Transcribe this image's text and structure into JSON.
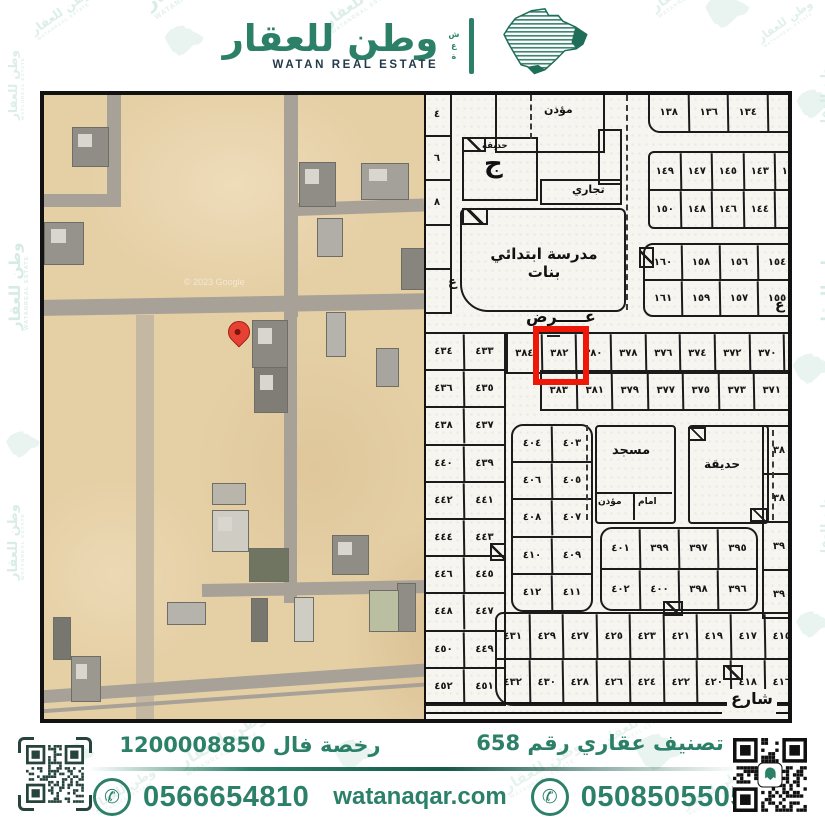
{
  "header": {
    "brand_ar": "وطن للعقار",
    "brand_en": "WATAN REAL ESTATE",
    "emblem_side_text": [
      "ش",
      "ع",
      "ة"
    ],
    "emblem_icon": "saudi-arabia-map",
    "brand_green": "#2c8068",
    "brand_navy": "#223a4b"
  },
  "watermark": {
    "text_ar": "وطن للعقار",
    "text_en": "WATANREAL ESTATE"
  },
  "satellite": {
    "credit": "© 2023 Google",
    "pin_color": "#e74133"
  },
  "map": {
    "street_label_top": "عـــــرض",
    "street_label_bottom": "شارع",
    "street_letter_right": "ع",
    "street_letter_left": "ع",
    "highlight_color": "#ee1708",
    "highlighted_plot": "٣٨٢",
    "labels": {
      "muezzin_top": "مؤذن",
      "park_top": "حديقة",
      "park_top_letter": "ج",
      "commercial": "تجاري",
      "school": "مدرسة ابتدائي بنات",
      "mosque": "مسجد",
      "imam": "امام",
      "muezzin": "مؤذن",
      "park": "حديقة"
    },
    "blocks": {
      "left_top_col": [
        [
          "٤"
        ],
        [
          "٦"
        ],
        [
          "٨"
        ],
        [
          ""
        ],
        [
          ""
        ]
      ],
      "top_right_1": [
        [
          "١٣٨",
          "١٣٦",
          "١٣٤",
          ""
        ]
      ],
      "top_right_2": [
        [
          "١٤٩",
          "١٤٧",
          "١٤٥",
          "١٤٣",
          "١٤١"
        ],
        [
          "١٥٠",
          "١٤٨",
          "١٤٦",
          "١٤٤",
          ""
        ]
      ],
      "top_right_3": [
        [
          "١٦٠",
          "١٥٨",
          "١٥٦",
          "١٥٤"
        ],
        [
          "١٦١",
          "١٥٩",
          "١٥٧",
          "١٥٥"
        ]
      ],
      "mid_row_1": [
        [
          "٣٨٤",
          "٣٨٢",
          "٣٨٠",
          "٣٧٨",
          "٣٧٦",
          "٣٧٤",
          "٣٧٢",
          "٣٧٠",
          "٣٦٨"
        ]
      ],
      "mid_row_2": [
        [
          "٣٨٣",
          "٣٨١",
          "٣٧٩",
          "٣٧٧",
          "٣٧٥",
          "٣٧٣",
          "٣٧١",
          "٣٦٩"
        ]
      ],
      "left_pairs": [
        [
          "٤٣٤",
          "٤٣٣"
        ],
        [
          "٤٣٦",
          "٤٣٥"
        ],
        [
          "٤٣٨",
          "٤٣٧"
        ],
        [
          "٤٤٠",
          "٤٣٩"
        ],
        [
          "٤٤٢",
          "٤٤١"
        ],
        [
          "٤٤٤",
          "٤٤٣"
        ],
        [
          "٤٤٦",
          "٤٤٥"
        ],
        [
          "٤٤٨",
          "٤٤٧"
        ],
        [
          "٤٥٠",
          "٤٤٩"
        ],
        [
          "٤٥٢",
          "٤٥١"
        ]
      ],
      "block_403": [
        [
          "٤٠٤",
          "٤٠٣"
        ],
        [
          "٤٠٦",
          "٤٠٥"
        ],
        [
          "٤٠٨",
          "٤٠٧"
        ],
        [
          "٤١٠",
          "٤٠٩"
        ],
        [
          "٤١٢",
          "٤١١"
        ]
      ],
      "block_395": [
        [
          "٤٠١",
          "٣٩٩",
          "٣٩٧",
          "٣٩٥"
        ],
        [
          "٤٠٢",
          "٤٠٠",
          "٣٩٨",
          "٣٩٦"
        ]
      ],
      "right_col": [
        [
          "٣٨"
        ],
        [
          "٣٨"
        ],
        [
          "٣٩"
        ],
        [
          "٣٩"
        ]
      ],
      "bottom_block": [
        [
          "٤٣١",
          "٤٢٩",
          "٤٢٧",
          "٤٢٥",
          "٤٢٣",
          "٤٢١",
          "٤١٩",
          "٤١٧",
          "٤١٥"
        ],
        [
          "٤٣٢",
          "٤٣٠",
          "٤٢٨",
          "٤٢٦",
          "٤٢٤",
          "٤٢٢",
          "٤٢٠",
          "٤١٨",
          "٤١٦"
        ]
      ]
    }
  },
  "footer": {
    "license_text": "رخصة فال 1200008850",
    "classification_text": "تصنيف عقاري رقم 658",
    "phone_left": "0566654810",
    "phone_right": "0508505505",
    "website": "watanaqar.com",
    "whatsapp_icon": "phone-in-circle",
    "qr_left": "qr-code",
    "qr_right": "qr-code-snapchat",
    "accent_green": "#2c8068"
  }
}
